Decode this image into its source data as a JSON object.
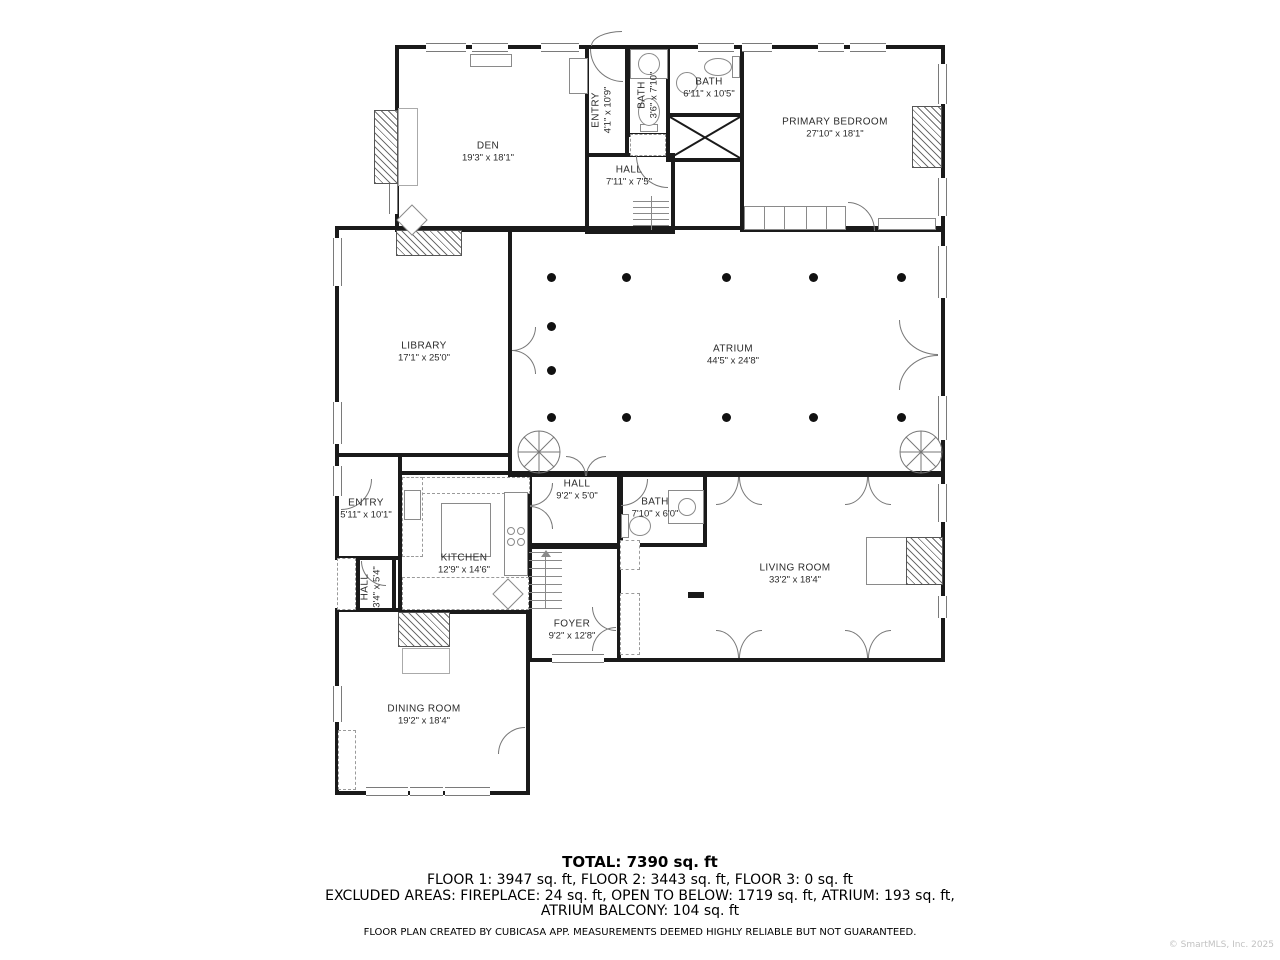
{
  "plan": {
    "rooms": [
      {
        "id": "den",
        "name": "DEN",
        "dims": "19'3\" x 18'1\"",
        "cx": 488,
        "cy": 152,
        "vertical": false
      },
      {
        "id": "entry-upper",
        "name": "ENTRY",
        "dims": "4'1\" x 10'9\"",
        "cx": 602,
        "cy": 110,
        "vertical": true
      },
      {
        "id": "bath-small",
        "name": "BATH",
        "dims": "3'6\" x 7'10\"",
        "cx": 648,
        "cy": 95,
        "vertical": true
      },
      {
        "id": "bath-upper",
        "name": "BATH",
        "dims": "6'11\" x 10'5\"",
        "cx": 709,
        "cy": 88,
        "vertical": false
      },
      {
        "id": "primary-bedroom",
        "name": "PRIMARY BEDROOM",
        "dims": "27'10\" x 18'1\"",
        "cx": 835,
        "cy": 128,
        "vertical": false
      },
      {
        "id": "hall-upper",
        "name": "HALL",
        "dims": "7'11\" x 7'5\"",
        "cx": 629,
        "cy": 176,
        "vertical": false
      },
      {
        "id": "library",
        "name": "LIBRARY",
        "dims": "17'1\" x 25'0\"",
        "cx": 424,
        "cy": 352,
        "vertical": false
      },
      {
        "id": "atrium",
        "name": "ATRIUM",
        "dims": "44'5\" x 24'8\"",
        "cx": 733,
        "cy": 355,
        "vertical": false
      },
      {
        "id": "entry-lower",
        "name": "ENTRY",
        "dims": "5'11\" x 10'1\"",
        "cx": 366,
        "cy": 509,
        "vertical": false
      },
      {
        "id": "kitchen",
        "name": "KITCHEN",
        "dims": "12'9\" x 14'6\"",
        "cx": 464,
        "cy": 564,
        "vertical": false
      },
      {
        "id": "hall-lower",
        "name": "HALL",
        "dims": "9'2\" x 5'0\"",
        "cx": 577,
        "cy": 490,
        "vertical": false
      },
      {
        "id": "hall-small",
        "name": "HALL",
        "dims": "3'4\" x 5'4\"",
        "cx": 371,
        "cy": 587,
        "vertical": true
      },
      {
        "id": "bath-lower",
        "name": "BATH",
        "dims": "7'10\" x 6'0\"",
        "cx": 655,
        "cy": 508,
        "vertical": false
      },
      {
        "id": "living-room",
        "name": "LIVING ROOM",
        "dims": "33'2\" x 18'4\"",
        "cx": 795,
        "cy": 574,
        "vertical": false
      },
      {
        "id": "foyer",
        "name": "FOYER",
        "dims": "9'2\" x 12'8\"",
        "cx": 572,
        "cy": 630,
        "vertical": false
      },
      {
        "id": "dining-room",
        "name": "DINING ROOM",
        "dims": "19'2\" x 18'4\"",
        "cx": 424,
        "cy": 715,
        "vertical": false
      }
    ]
  },
  "summary": {
    "total": "TOTAL: 7390 sq. ft",
    "floors": "FLOOR 1: 3947 sq. ft, FLOOR 2: 3443 sq. ft, FLOOR 3: 0 sq. ft",
    "excluded_line1": "EXCLUDED AREAS: FIREPLACE: 24 sq. ft, OPEN TO BELOW: 1719 sq. ft, ATRIUM: 193 sq. ft,",
    "excluded_line2": "ATRIUM BALCONY: 104 sq. ft",
    "disclaimer": "FLOOR PLAN CREATED BY CUBICASA APP. MEASUREMENTS DEEMED HIGHLY RELIABLE BUT NOT GUARANTEED."
  },
  "watermark": "© SmartMLS, Inc. 2025"
}
